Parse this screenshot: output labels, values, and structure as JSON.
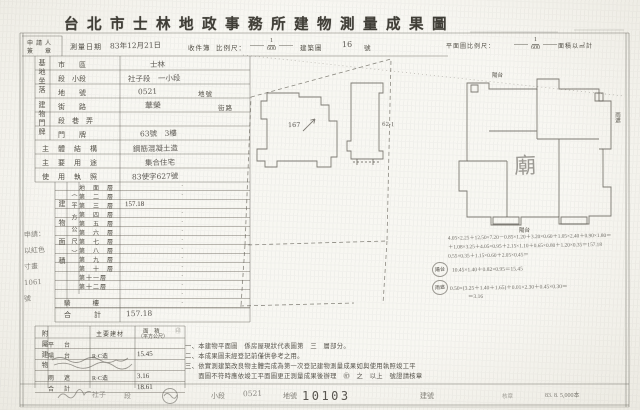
{
  "title": "台北市士林地政事務所建物測量成果圖",
  "header": {
    "applicant_line1": "申請人",
    "applicant_line2": "簽　章",
    "survey_date_label": "測量日期",
    "survey_date": "83年12月21日",
    "recv_label": "收件簿",
    "scale_label": "比例尺：",
    "scale_num": "1",
    "scale_den": "600",
    "sheet_label": "建築圖",
    "sheet_no": "16",
    "sheet_no_unit": "號",
    "plan_scale_label": "平面圖比例尺：",
    "plan_scale_num": "1",
    "plan_scale_den": "600",
    "plan_scale_note": "面積以㎡計"
  },
  "site": {
    "group_label": "基地坐落",
    "r1_label": "市　　區",
    "r1_value": "士林",
    "r2_label": "段　小段",
    "r2_value": "社子段　一小段",
    "r3_label": "地　　號",
    "r3_value": "0521",
    "r3_suffix": "地號"
  },
  "door": {
    "group_label": "建物門牌",
    "r1_label": "街　　路",
    "r1_value": "華榮",
    "r1_suffix": "街路",
    "r2_label": "段　巷　弄",
    "r2_value": "",
    "r3_label": "門　　牌",
    "r3_value": "63號　3樓"
  },
  "info": {
    "structure_label": "主體結構",
    "structure_value": "鋼筋混凝土造",
    "use_label": "主要用途",
    "use_value": "集合住宅",
    "license_label": "使用執照",
    "license_value": "83使字627號"
  },
  "area": {
    "group_label": "建物面積",
    "unit_label": "（平方公尺）",
    "floors": [
      {
        "name": "地　面　層",
        "value": "·"
      },
      {
        "name": "第　二　層",
        "value": "·"
      },
      {
        "name": "第　三　層",
        "value": "157.18"
      },
      {
        "name": "第　四　層",
        "value": "·"
      },
      {
        "name": "第　五　層",
        "value": "·"
      },
      {
        "name": "第　六　層",
        "value": "·"
      },
      {
        "name": "第　七　層",
        "value": "·"
      },
      {
        "name": "第　八　層",
        "value": "·"
      },
      {
        "name": "第　九　層",
        "value": "·"
      },
      {
        "name": "第　十　層",
        "value": "·"
      },
      {
        "name": "第十一層",
        "value": "·"
      },
      {
        "name": "第十二層",
        "value": "·"
      },
      {
        "name": "",
        "value": "·"
      },
      {
        "name": "",
        "value": "·"
      }
    ],
    "arcade_label": "騎　　樓",
    "total_label": "合　　計",
    "total_value": "157.18"
  },
  "annex": {
    "group_label": "附屬建物",
    "col_material": "主要建材",
    "col_area1": "面　積",
    "col_area2": "（平方公尺）",
    "seal": "㊞",
    "rows": [
      {
        "use": "平　台",
        "material": "",
        "area": ""
      },
      {
        "use": "陽　台",
        "material": "R·C造",
        "area": "15.45"
      },
      {
        "use": "",
        "material": "",
        "area": ""
      },
      {
        "use": "雨　遮",
        "material": "R·C造",
        "area": "3.16"
      },
      {
        "use": "合　計",
        "material": "",
        "area": "18.61"
      }
    ]
  },
  "margin_lines": [
    "申請：",
    "以紅色",
    "寸畫",
    "1061",
    "號"
  ],
  "plans": {
    "bldg_label": "167",
    "lot_label": "62-1",
    "center_char": "廟",
    "balcony_top": "陽台",
    "canopy_right": "雨遮",
    "balcony_bottom": "陽台"
  },
  "calc": {
    "main_lines": [
      "4.05×2.25＋12.50×7.20－0.85×1.20＋3.20×0.60＋1.05×2.40＋0.90×1.80＝",
      "＋1.08×3.25＋4.05×0.95＋2.15×1.10＋0.65×0.80＋1.20×0.35＝157.18",
      "0.55×0.35＋1.15×0.60＋2.05×0.45＝"
    ],
    "balcony_stamp": "陽台",
    "balcony_line": "10.45×1.40＋0.82×0.95＝15.45",
    "canopy_stamp": "雨遮",
    "canopy_line": "0.50×(3.25＋1.40＋1.65)＋0.01×2.30＋0.45×0.30＝",
    "canopy_line2": "＝3.16"
  },
  "notes": [
    "一、本建物平面圖　係房屋現狀代表圖第　三　層部分。",
    "二、本成果圖未經登記前僅供參考之用。",
    "三、依實測建築改良物主體完成為第一次登記建物測量成果如與使用執照竣工平",
    "　　面圖不符時應依竣工平面圖更正測量成果後辦理　㊞　之　以上　號證請核章"
  ],
  "footer": {
    "hand_sec": "社子",
    "sec_label": "段",
    "subsec_label": "小段",
    "hand_lot": "0521",
    "lot_label": "地號",
    "serial": "10103",
    "bldg_label": "建號",
    "mid_token": "核章",
    "print_note": "83. 8. 5,000本"
  }
}
